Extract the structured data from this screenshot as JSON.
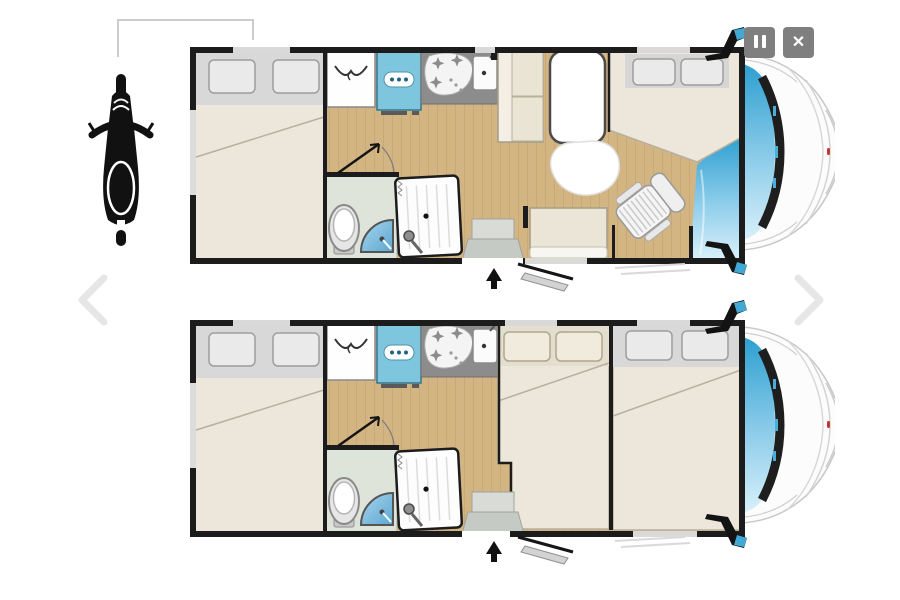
{
  "viewer": {
    "type": "motorhome-floorplan-slideshow",
    "background": "#ffffff",
    "slide_count": 2
  },
  "controls": {
    "pause": {
      "label": "Pause slideshow",
      "icon": "pause-icon"
    },
    "close": {
      "label": "Close viewer",
      "icon": "close-icon",
      "glyph": "✕"
    },
    "prev": {
      "label": "Previous layout",
      "icon": "chevron-left-icon"
    },
    "next": {
      "label": "Next layout",
      "icon": "chevron-right-icon"
    }
  },
  "legend": {
    "garage_item": "motorcycle",
    "callout": "rear-garage-storage-bracket"
  },
  "plans": [
    {
      "name": "day-layout",
      "position": "top",
      "features": [
        "rear-french-bed",
        "wardrobe",
        "refrigerator",
        "hob-unit",
        "kitchen-sink",
        "bathroom-toilet",
        "corner-washbasin",
        "shower-cubicle",
        "bathroom-door-swing",
        "dinette-bench",
        "pedestal-table",
        "side-table",
        "entrance-bench",
        "swivel-cab-seat",
        "over-cab-bed",
        "entry-steps",
        "open-entry-door",
        "entry-arrow",
        "cab-windshield",
        "wing-mirrors"
      ]
    },
    {
      "name": "night-layout",
      "position": "bottom",
      "features": [
        "rear-french-bed",
        "wardrobe",
        "refrigerator",
        "hob-unit",
        "kitchen-sink",
        "bathroom-toilet",
        "corner-washbasin",
        "shower-cubicle",
        "bathroom-door-swing",
        "converted-dinette-double-bed",
        "drop-down-cab-double-bed",
        "entry-steps",
        "open-entry-door",
        "entry-arrow",
        "cab-windshield",
        "wing-mirrors"
      ]
    }
  ],
  "colors": {
    "wall": "#1c1c1c",
    "wood_floor": "#d3b583",
    "bed_mattress": "#ece7da",
    "pillow_zone": "#d8d8d8",
    "fridge_blue": "#7ec6de",
    "counter_gray": "#8c8c8c",
    "bathroom_floor": "#dee4d9",
    "basin_blue": "#7fbfe3",
    "windshield_top": "#2d9fd0",
    "windshield_bottom": "#d8f0fa",
    "button_gray": "#7f7f7f",
    "chevron_gray": "#e6e6e6",
    "accent_red": "#c0392b"
  }
}
